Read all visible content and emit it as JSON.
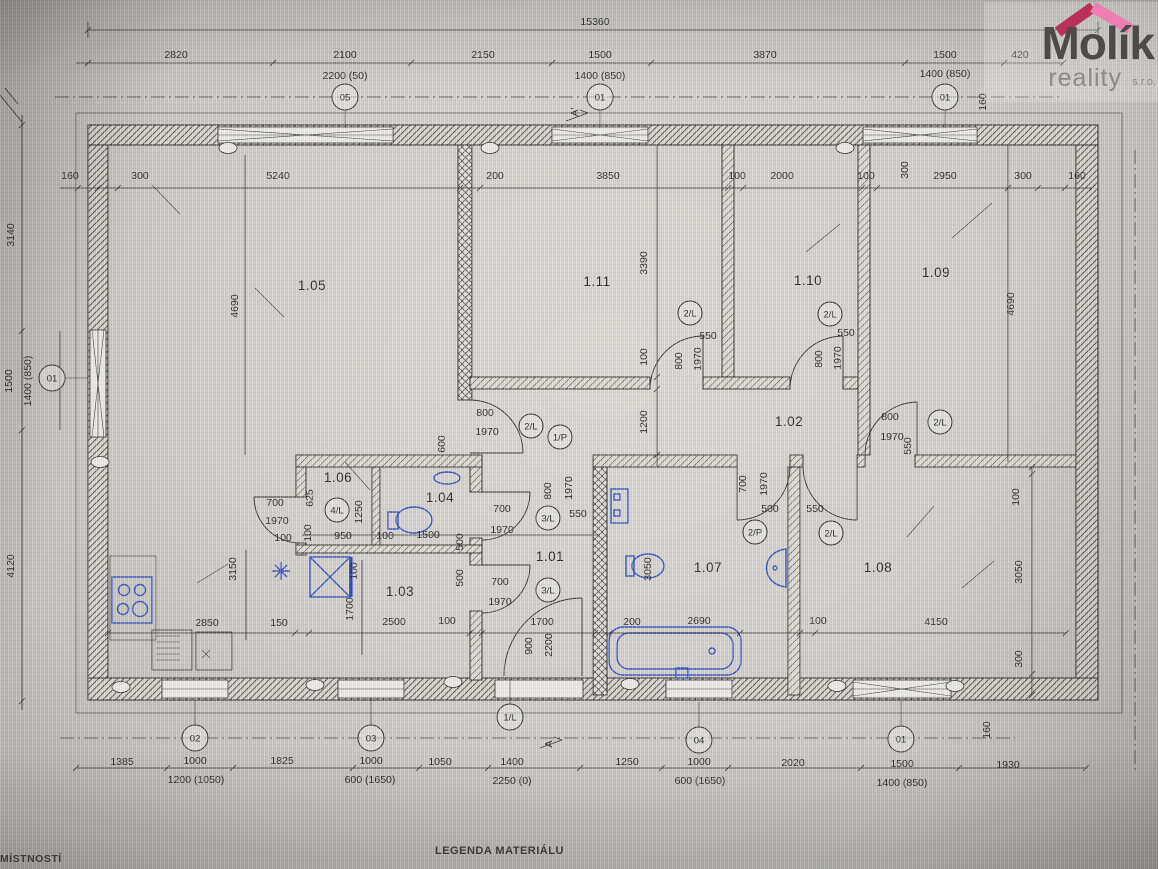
{
  "logo": {
    "brand": "Molík",
    "line2": "reality",
    "suffix": "s.r.o.",
    "roof_left_color": "#b93058",
    "roof_right_color": "#ee7fb0"
  },
  "footer": {
    "left_text": "MÍSTNOSTÍ",
    "legend_text": "LEGENDA MATERIÁLU"
  },
  "colors": {
    "ink": "#2c2c2c",
    "fixture_blue": "#3352bd",
    "paper": "#d2cfca"
  },
  "plan": {
    "rooms": [
      {
        "id": "1.05",
        "x": 312,
        "y": 290
      },
      {
        "id": "1.11",
        "x": 597,
        "y": 286
      },
      {
        "id": "1.10",
        "x": 808,
        "y": 285
      },
      {
        "id": "1.09",
        "x": 936,
        "y": 277
      },
      {
        "id": "1.02",
        "x": 789,
        "y": 426
      },
      {
        "id": "1.06",
        "x": 338,
        "y": 482
      },
      {
        "id": "1.04",
        "x": 440,
        "y": 502
      },
      {
        "id": "1.01",
        "x": 550,
        "y": 561
      },
      {
        "id": "1.03",
        "x": 400,
        "y": 596
      },
      {
        "id": "1.07",
        "x": 708,
        "y": 572
      },
      {
        "id": "1.08",
        "x": 878,
        "y": 572
      }
    ],
    "dim_labels": [
      {
        "t": "15360",
        "x": 595,
        "y": 25
      },
      {
        "t": "2820",
        "x": 176,
        "y": 58
      },
      {
        "t": "2100",
        "x": 345,
        "y": 58
      },
      {
        "t": "2150",
        "x": 483,
        "y": 58
      },
      {
        "t": "1500",
        "x": 600,
        "y": 58
      },
      {
        "t": "3870",
        "x": 765,
        "y": 58
      },
      {
        "t": "1500",
        "x": 945,
        "y": 58
      },
      {
        "t": "420",
        "x": 1020,
        "y": 58
      },
      {
        "t": "2200 (50)",
        "x": 345,
        "y": 79
      },
      {
        "t": "1400 (850)",
        "x": 600,
        "y": 79
      },
      {
        "t": "1400 (850)",
        "x": 945,
        "y": 77
      },
      {
        "t": "160",
        "x": 70,
        "y": 179
      },
      {
        "t": "300",
        "x": 140,
        "y": 179
      },
      {
        "t": "5240",
        "x": 278,
        "y": 179
      },
      {
        "t": "200",
        "x": 495,
        "y": 179
      },
      {
        "t": "3850",
        "x": 608,
        "y": 179
      },
      {
        "t": "100",
        "x": 737,
        "y": 179
      },
      {
        "t": "2000",
        "x": 782,
        "y": 179
      },
      {
        "t": "100",
        "x": 866,
        "y": 179
      },
      {
        "t": "2950",
        "x": 945,
        "y": 179
      },
      {
        "t": "300",
        "x": 1023,
        "y": 179
      },
      {
        "t": "160",
        "x": 1077,
        "y": 179
      },
      {
        "t": "300",
        "x": 908,
        "y": 170,
        "r": -90
      },
      {
        "t": "160",
        "x": 986,
        "y": 102,
        "r": -90
      },
      {
        "t": "3140",
        "x": 14,
        "y": 235,
        "r": -90
      },
      {
        "t": "1500",
        "x": 12,
        "y": 381,
        "r": -90
      },
      {
        "t": "1400 (850)",
        "x": 31,
        "y": 381,
        "r": -90
      },
      {
        "t": "4120",
        "x": 14,
        "y": 566,
        "r": -90
      },
      {
        "t": "4690",
        "x": 238,
        "y": 306,
        "r": -90
      },
      {
        "t": "4690",
        "x": 1014,
        "y": 304,
        "r": -90
      },
      {
        "t": "3390",
        "x": 647,
        "y": 263,
        "r": -90
      },
      {
        "t": "100",
        "x": 647,
        "y": 357,
        "r": -90
      },
      {
        "t": "1200",
        "x": 647,
        "y": 422,
        "r": -90
      },
      {
        "t": "600",
        "x": 445,
        "y": 444,
        "r": -90
      },
      {
        "t": "3150",
        "x": 236,
        "y": 569,
        "r": -90
      },
      {
        "t": "1700",
        "x": 353,
        "y": 609,
        "r": -90
      },
      {
        "t": "100",
        "x": 357,
        "y": 571,
        "r": -90
      },
      {
        "t": "900",
        "x": 532,
        "y": 646,
        "r": -90
      },
      {
        "t": "2200",
        "x": 552,
        "y": 645,
        "r": -90
      },
      {
        "t": "3050",
        "x": 651,
        "y": 569,
        "r": -90
      },
      {
        "t": "100",
        "x": 1019,
        "y": 497,
        "r": -90
      },
      {
        "t": "3050",
        "x": 1022,
        "y": 572,
        "r": -90
      },
      {
        "t": "300",
        "x": 1022,
        "y": 659,
        "r": -90
      },
      {
        "t": "160",
        "x": 990,
        "y": 730,
        "r": -90
      },
      {
        "t": "625",
        "x": 313,
        "y": 498,
        "r": -90
      },
      {
        "t": "1250",
        "x": 362,
        "y": 512,
        "r": -90
      },
      {
        "t": "100",
        "x": 311,
        "y": 533,
        "r": -90
      },
      {
        "t": "800",
        "x": 682,
        "y": 361,
        "r": -90
      },
      {
        "t": "1970",
        "x": 701,
        "y": 359,
        "r": -90
      },
      {
        "t": "800",
        "x": 822,
        "y": 359,
        "r": -90
      },
      {
        "t": "1970",
        "x": 841,
        "y": 358,
        "r": -90
      },
      {
        "t": "800",
        "x": 551,
        "y": 491,
        "r": -90
      },
      {
        "t": "1970",
        "x": 572,
        "y": 488,
        "r": -90
      },
      {
        "t": "500",
        "x": 463,
        "y": 542,
        "r": -90
      },
      {
        "t": "500",
        "x": 463,
        "y": 578,
        "r": -90
      },
      {
        "t": "700",
        "x": 746,
        "y": 484,
        "r": -90
      },
      {
        "t": "1970",
        "x": 767,
        "y": 484,
        "r": -90
      },
      {
        "t": "550",
        "x": 911,
        "y": 446,
        "r": -90
      },
      {
        "t": "550",
        "x": 708,
        "y": 339
      },
      {
        "t": "550",
        "x": 846,
        "y": 336
      },
      {
        "t": "800",
        "x": 485,
        "y": 416
      },
      {
        "t": "1970",
        "x": 487,
        "y": 435
      },
      {
        "t": "550",
        "x": 578,
        "y": 517
      },
      {
        "t": "700",
        "x": 502,
        "y": 512
      },
      {
        "t": "1970",
        "x": 502,
        "y": 533
      },
      {
        "t": "700",
        "x": 500,
        "y": 585
      },
      {
        "t": "1970",
        "x": 500,
        "y": 605
      },
      {
        "t": "700",
        "x": 275,
        "y": 506
      },
      {
        "t": "1970",
        "x": 277,
        "y": 524
      },
      {
        "t": "100",
        "x": 283,
        "y": 541
      },
      {
        "t": "950",
        "x": 343,
        "y": 539
      },
      {
        "t": "100",
        "x": 385,
        "y": 539
      },
      {
        "t": "1500",
        "x": 428,
        "y": 538
      },
      {
        "t": "500",
        "x": 770,
        "y": 512
      },
      {
        "t": "550",
        "x": 815,
        "y": 512
      },
      {
        "t": "800",
        "x": 890,
        "y": 420
      },
      {
        "t": "1970",
        "x": 892,
        "y": 440
      },
      {
        "t": "2850",
        "x": 207,
        "y": 626
      },
      {
        "t": "150",
        "x": 279,
        "y": 626
      },
      {
        "t": "2500",
        "x": 394,
        "y": 625
      },
      {
        "t": "100",
        "x": 447,
        "y": 624
      },
      {
        "t": "1700",
        "x": 542,
        "y": 625
      },
      {
        "t": "200",
        "x": 632,
        "y": 625
      },
      {
        "t": "2690",
        "x": 699,
        "y": 624
      },
      {
        "t": "100",
        "x": 818,
        "y": 624
      },
      {
        "t": "4150",
        "x": 936,
        "y": 625
      },
      {
        "t": "1385",
        "x": 122,
        "y": 765
      },
      {
        "t": "1000",
        "x": 195,
        "y": 764
      },
      {
        "t": "1825",
        "x": 282,
        "y": 764
      },
      {
        "t": "1000",
        "x": 371,
        "y": 764
      },
      {
        "t": "1050",
        "x": 440,
        "y": 765
      },
      {
        "t": "1400",
        "x": 512,
        "y": 765
      },
      {
        "t": "1250",
        "x": 627,
        "y": 765
      },
      {
        "t": "1000",
        "x": 699,
        "y": 765
      },
      {
        "t": "2020",
        "x": 793,
        "y": 766
      },
      {
        "t": "1500",
        "x": 902,
        "y": 767
      },
      {
        "t": "1930",
        "x": 1008,
        "y": 768
      },
      {
        "t": "1200 (1050)",
        "x": 196,
        "y": 783
      },
      {
        "t": "600 (1650)",
        "x": 370,
        "y": 783
      },
      {
        "t": "2250 (0)",
        "x": 512,
        "y": 784
      },
      {
        "t": "600 (1650)",
        "x": 700,
        "y": 784
      },
      {
        "t": "1400 (850)",
        "x": 902,
        "y": 786
      }
    ],
    "circle_markers": [
      {
        "t": "05",
        "x": 345,
        "y": 97,
        "lead": "d"
      },
      {
        "t": "01",
        "x": 600,
        "y": 97,
        "lead": "d"
      },
      {
        "t": "01",
        "x": 945,
        "y": 97,
        "lead": "d"
      },
      {
        "t": "01",
        "x": 52,
        "y": 378,
        "lead": "r"
      },
      {
        "t": "02",
        "x": 195,
        "y": 738,
        "lead": "u"
      },
      {
        "t": "03",
        "x": 371,
        "y": 738,
        "lead": "u"
      },
      {
        "t": "04",
        "x": 699,
        "y": 740,
        "lead": "u"
      },
      {
        "t": "01",
        "x": 901,
        "y": 739,
        "lead": "u"
      },
      {
        "t": "1/L",
        "x": 510,
        "y": 717,
        "lead": "u"
      }
    ],
    "door_markers": [
      {
        "t": "2/L",
        "x": 531,
        "y": 426
      },
      {
        "t": "1/P",
        "x": 560,
        "y": 437
      },
      {
        "t": "4/L",
        "x": 337,
        "y": 510
      },
      {
        "t": "3/L",
        "x": 548,
        "y": 518
      },
      {
        "t": "3/L",
        "x": 548,
        "y": 590
      },
      {
        "t": "2/P",
        "x": 755,
        "y": 532
      },
      {
        "t": "2/L",
        "x": 831,
        "y": 533
      },
      {
        "t": "2/L",
        "x": 690,
        "y": 313
      },
      {
        "t": "2/L",
        "x": 830,
        "y": 314
      },
      {
        "t": "2/L",
        "x": 940,
        "y": 422
      }
    ],
    "section_markers": [
      {
        "t": "A'",
        "x": 578,
        "y": 112,
        "r": -90
      },
      {
        "t": "A",
        "x": 552,
        "y": 744,
        "r": -90
      }
    ],
    "wall_ovals": [
      {
        "x": 228,
        "y": 148
      },
      {
        "x": 490,
        "y": 148
      },
      {
        "x": 845,
        "y": 148
      },
      {
        "x": 100,
        "y": 462
      },
      {
        "x": 121,
        "y": 687
      },
      {
        "x": 315,
        "y": 685
      },
      {
        "x": 453,
        "y": 682
      },
      {
        "x": 630,
        "y": 684
      },
      {
        "x": 837,
        "y": 686
      },
      {
        "x": 955,
        "y": 686
      }
    ]
  }
}
